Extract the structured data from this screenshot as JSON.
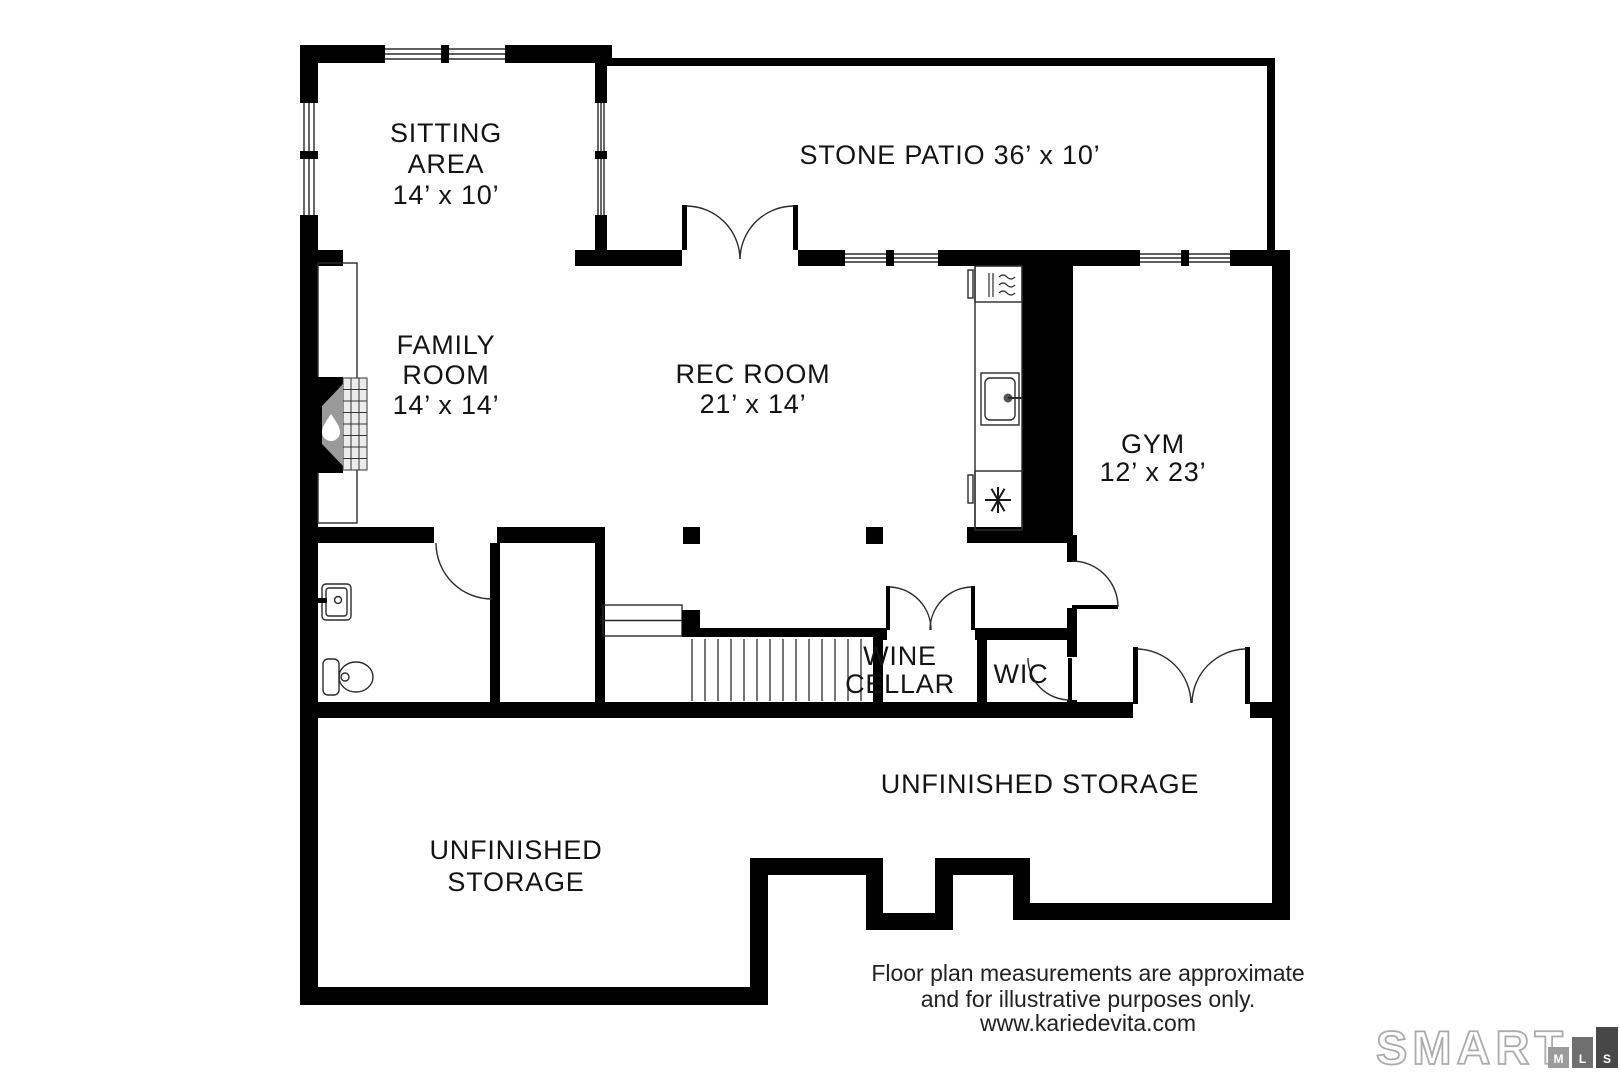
{
  "rooms": [
    {
      "key": "sitting-area",
      "lines": [
        "SITTING",
        "AREA",
        "14’ x 10’"
      ]
    },
    {
      "key": "stone-patio",
      "lines": [
        "STONE PATIO 36’ x 10’"
      ]
    },
    {
      "key": "family-room",
      "lines": [
        "FAMILY",
        "ROOM",
        "14’ x 14’"
      ]
    },
    {
      "key": "rec-room",
      "lines": [
        "REC ROOM",
        "21’ x 14’"
      ]
    },
    {
      "key": "gym",
      "lines": [
        "GYM",
        "12’ x 23’"
      ]
    },
    {
      "key": "wine-cellar",
      "lines": [
        "WINE",
        "CELLAR"
      ]
    },
    {
      "key": "wic",
      "lines": [
        "WIC"
      ]
    },
    {
      "key": "unfinished-storage-right",
      "lines": [
        "UNFINISHED STORAGE"
      ]
    },
    {
      "key": "unfinished-storage-left",
      "lines": [
        "UNFINISHED",
        "STORAGE"
      ]
    }
  ],
  "disclaimer": {
    "line1": "Floor plan measurements are approximate",
    "line2": "and for illustrative purposes only.",
    "line3": "www.kariedevita.com"
  },
  "logo": {
    "word": "SMART",
    "outline_color": "#ababab",
    "tiles": [
      {
        "letter": "M",
        "color": "#9b9b9b"
      },
      {
        "letter": "L",
        "color": "#6f6f6f"
      },
      {
        "letter": "S",
        "color": "#474747"
      }
    ]
  },
  "colors": {
    "wall": "#000000",
    "text": "#141414",
    "firebox": "#9a9a9a"
  }
}
